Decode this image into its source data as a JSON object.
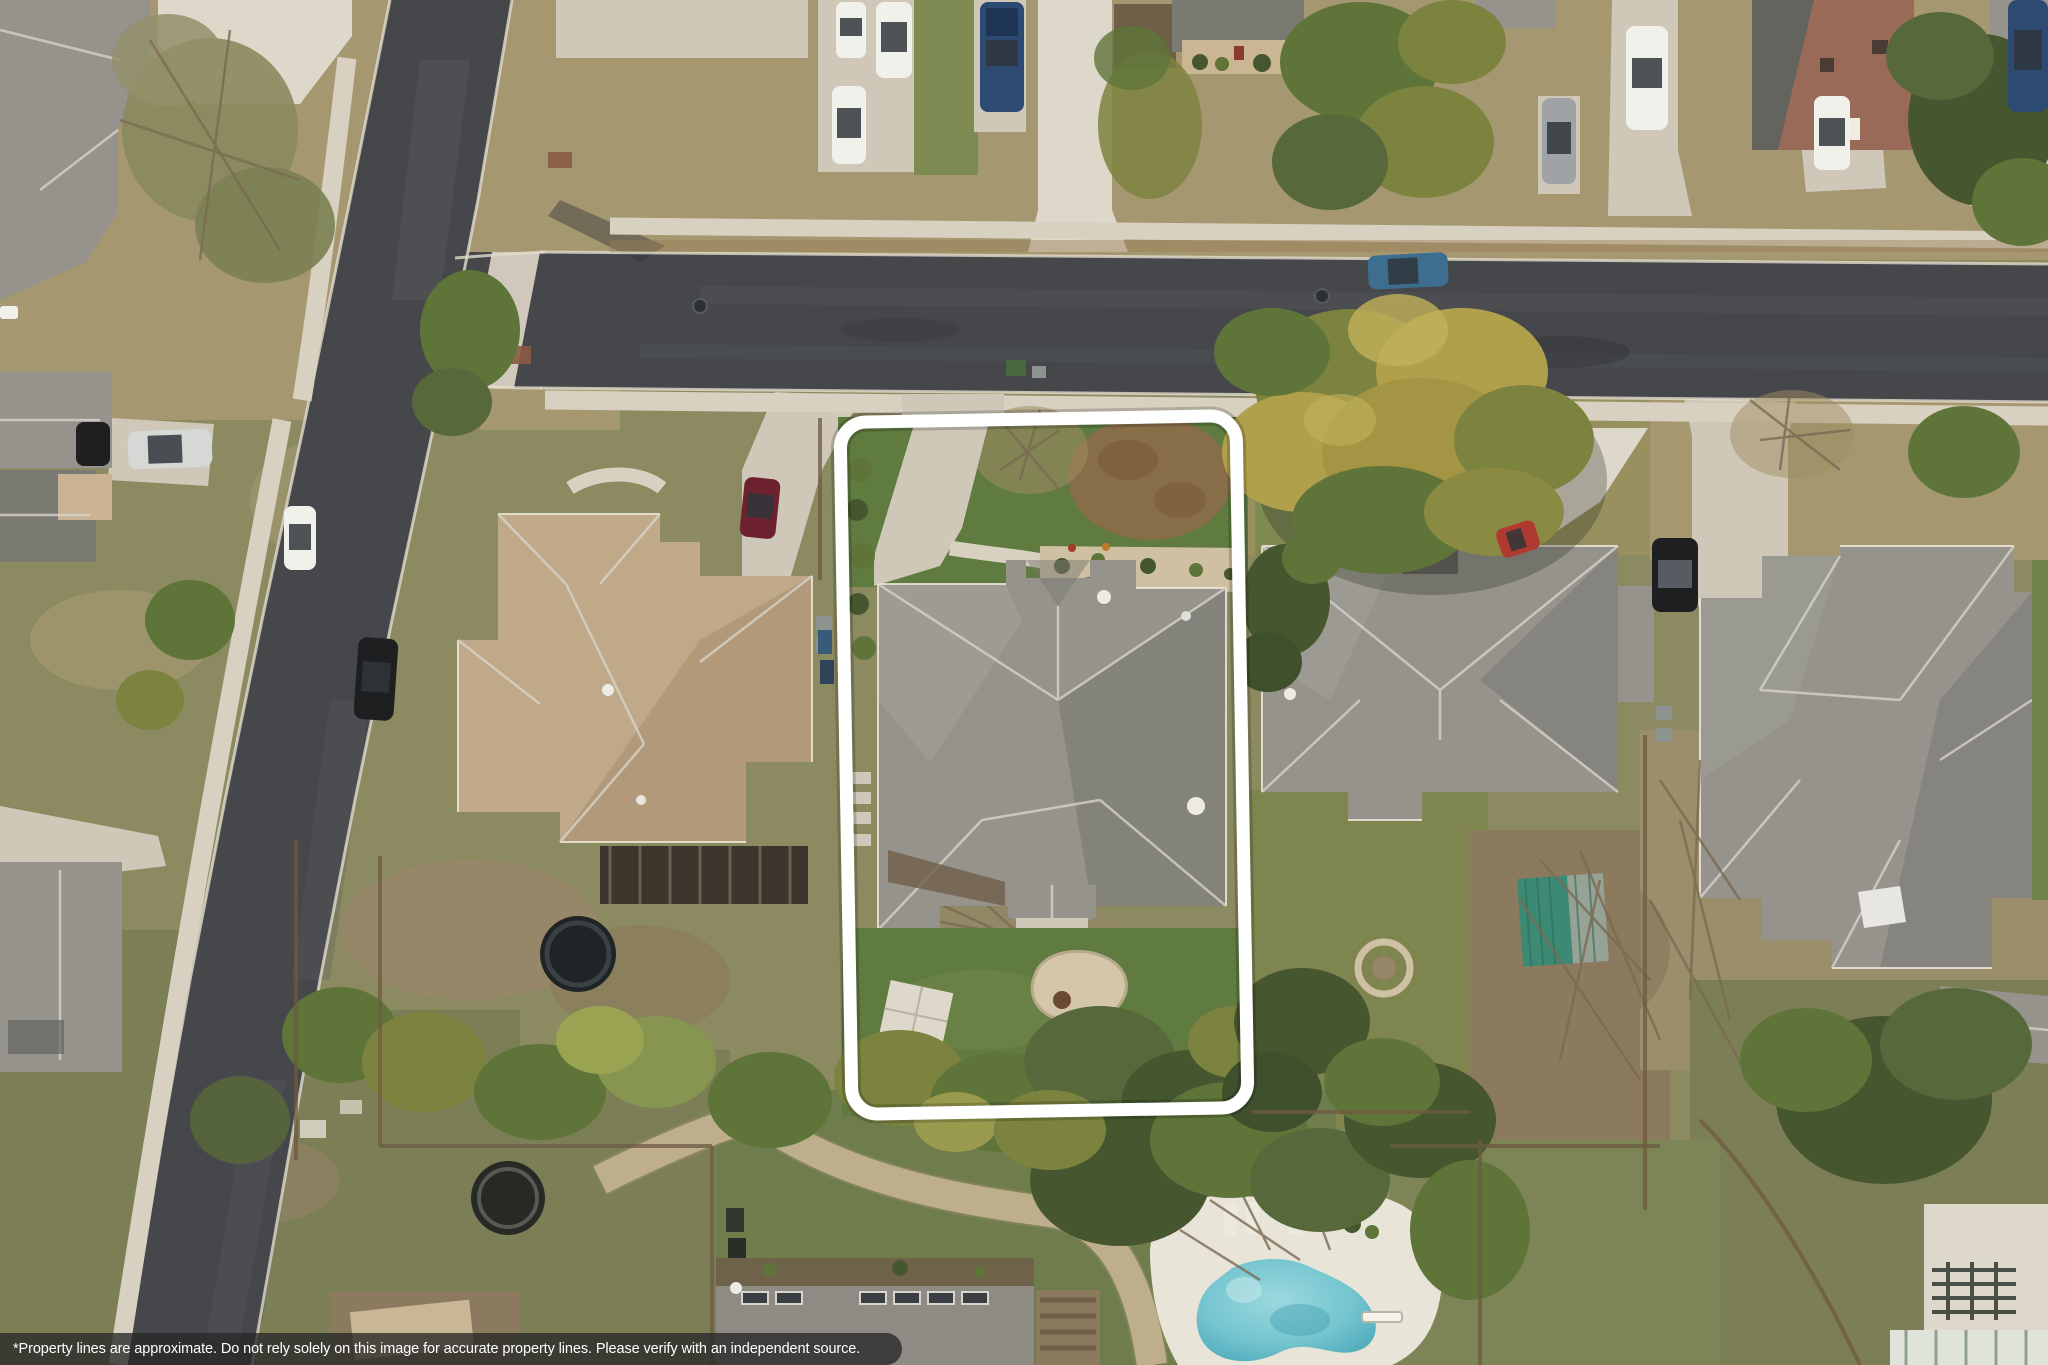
{
  "image": {
    "kind": "aerial drone photograph",
    "description": "Top-down aerial view of a suburban neighborhood with one lot outlined in white",
    "width_px": 2048,
    "height_px": 1365
  },
  "disclaimer": {
    "text": "*Property lines are approximate. Do not rely solely on this image for accurate property lines. Please verify with an independent source.",
    "bar_color": "rgba(40,40,40,0.78)",
    "text_color": "#ffffff"
  },
  "property_outline": {
    "shape": "rounded rectangle",
    "color": "#ffffff"
  },
  "scene": {
    "objects": [
      "diagonal residential street (left)",
      "cross street (horizontal, upper middle)",
      "concrete sidewalks and driveways",
      "outlined subject lot: gray-roof house, front driveway, curved walkway, green lawns, rear patio slab, gravel bed",
      "tan-roof neighbor house (west)",
      "gray-roof neighbor house (east) with teal garden shed and stone fire-pit ring",
      "large gray-roof house (far right)",
      "large yellow-green tree over the cross street",
      "freeform swimming pool with white deck, lounge chairs and diving board (bottom)",
      "trampoline and round stock-tank pool (bottom left backyards)",
      "stone garden path below the outlined lot",
      "parked cars on streets and driveways",
      "wood fences between backyards"
    ]
  },
  "colors": {
    "asphalt": "#45474a",
    "asphalt-light": "#5b5e61",
    "asphalt-dark": "#33363a",
    "sidewalk": "#d8d1c1",
    "concrete": "#cfc8b8",
    "concrete-bright": "#ded8ca",
    "curb": "#e2dccd",
    "grass-green": "#5f7b40",
    "grass-olive": "#8b8a60",
    "grass-dry": "#a59871",
    "grass-dull": "#7c7f56",
    "dirt": "#98866a",
    "mulch": "#8b7a5e",
    "dirt-dark": "#6f5f49",
    "roof-gray": "#95938c",
    "roof-gray-dark": "#7a7972",
    "roof-gray-darker": "#64645e",
    "roof-tan": "#c0a988",
    "roof-tan-dark": "#a68f72",
    "tree-dark": "#46572f",
    "tree-green": "#5f7439",
    "tree-olive": "#7c833f",
    "tree-yellow": "#b0a04c",
    "tree-dry": "#a08c62",
    "fence": "#6e5a40",
    "car-white": "#f1f1ec",
    "car-silver": "#d6d8d6",
    "car-gray": "#9fa3a6",
    "car-blue": "#2c4a72",
    "car-teal": "#3d6e8f",
    "car-maroon": "#6e2230",
    "car-red": "#b03a30",
    "car-black": "#1d1f21",
    "pool-water": "#74c5cf",
    "pool-deck": "#e9e4d8",
    "shed-teal": "#3c8a73",
    "shed-gray": "#95a294",
    "bar": "rgba(40,40,40,0.78)",
    "bar-text": "#ffffff",
    "outline": "#ffffff"
  }
}
